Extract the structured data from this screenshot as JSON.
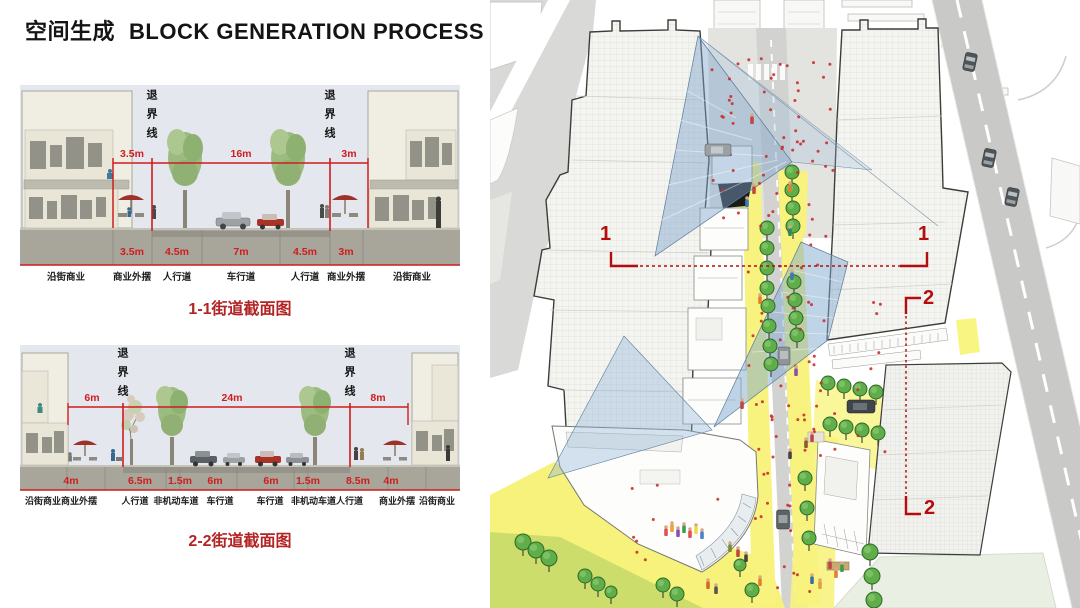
{
  "title": {
    "zh": "空间生成",
    "en": "BLOCK GENERATION PROCESS"
  },
  "figures": [
    {
      "caption": "1-1街道截面图",
      "setback_line": "退界线",
      "top_dims": [
        "3.5m",
        "16m",
        "3m"
      ],
      "bottom_dims": [
        "3.5m",
        "4.5m",
        "7m",
        "4.5m",
        "3m"
      ],
      "zones": [
        "沿街商业",
        "商业外摆",
        "人行道",
        "车行道",
        "人行道",
        "商业外摆",
        "沿街商业"
      ]
    },
    {
      "caption": "2-2街道截面图",
      "setback_line": "退界线",
      "top_dims": [
        "6m",
        "24m",
        "8m"
      ],
      "bottom_dims": [
        "4m",
        "6.5m",
        "1.5m",
        "6m",
        "6m",
        "1.5m",
        "8.5m",
        "4m"
      ],
      "zones": [
        "沿街商业商业外摆",
        "人行道",
        "非机动车道",
        "车行道",
        "车行道",
        "非机动车道人行道",
        "商业外摆",
        "沿街商业"
      ]
    }
  ],
  "site_plan": {
    "section_marker_1": "1",
    "section_marker_2": "2"
  },
  "colors": {
    "dim_red": "#cf1d1d",
    "caption_red": "#b32424",
    "marker_red": "#b50d0d",
    "plaza_yellow": "#f7f37e",
    "lawn_green": "#cddd6b",
    "tree_green": "#5fae4a",
    "cone_blue": "#7da5cd"
  }
}
